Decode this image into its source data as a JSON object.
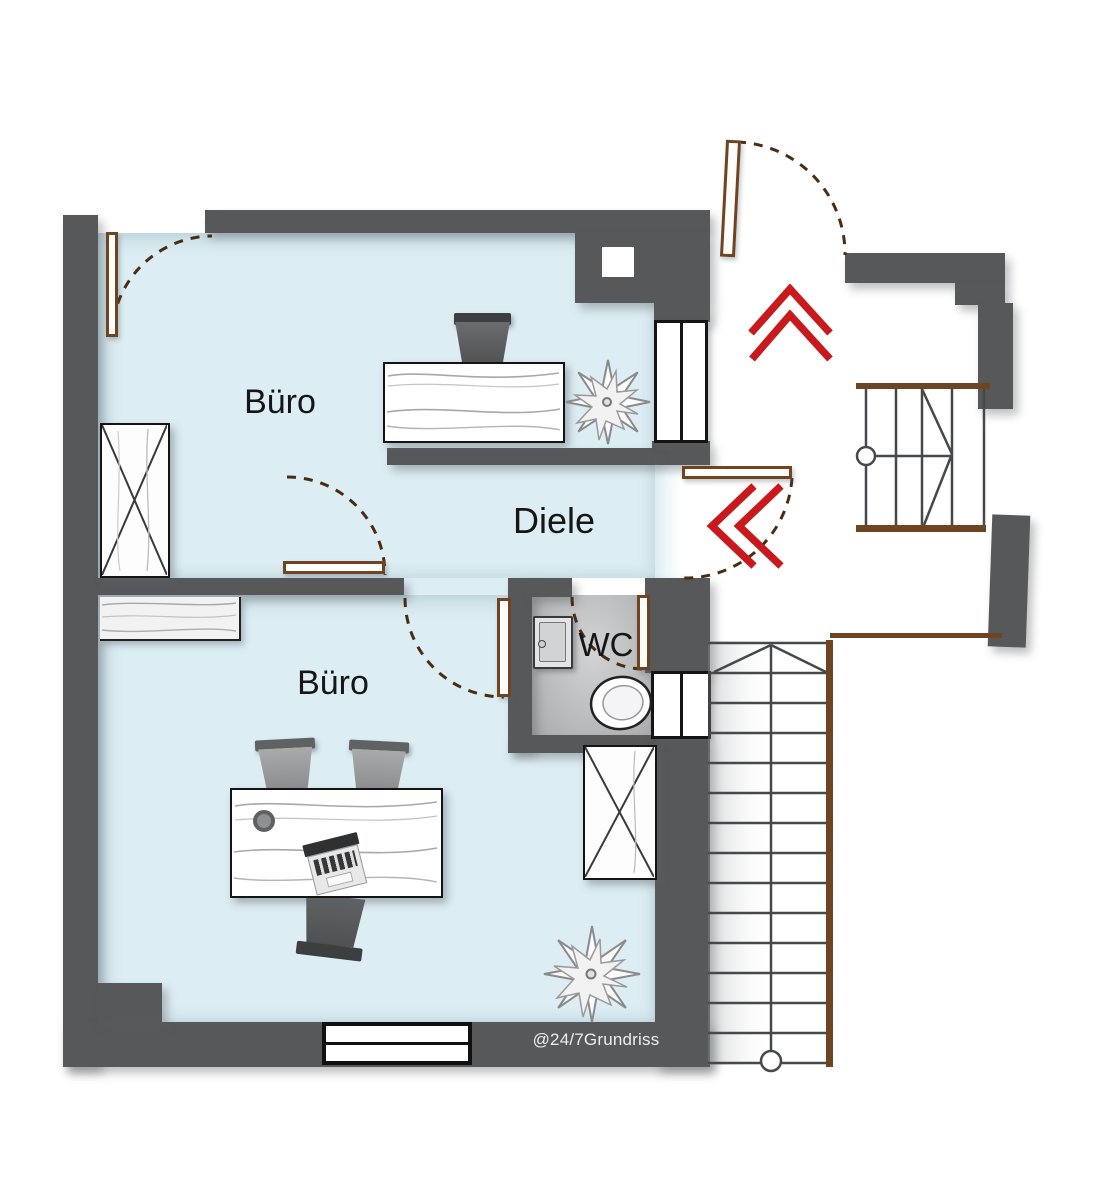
{
  "floorplan": {
    "watermark": "@24/7Grundriss",
    "rooms": [
      {
        "id": "buero-top",
        "label": "Büro"
      },
      {
        "id": "diele",
        "label": "Diele"
      },
      {
        "id": "wc",
        "label": "WC"
      },
      {
        "id": "buero-bottom",
        "label": "Büro"
      }
    ],
    "colors": {
      "wall": "#57585a",
      "room_floor": "#dcedf3",
      "wc_floor": "#b9babc",
      "door_frame": "#6e4423",
      "entrance_arrows": "#c8191c"
    },
    "features": {
      "entrance_direction_arrow": "double-chevron-up",
      "diele_entry_arrow": "double-chevron-left",
      "lower_stairs_treads": 14,
      "upper_stairs": "winder-stairs",
      "doors": 6
    }
  }
}
